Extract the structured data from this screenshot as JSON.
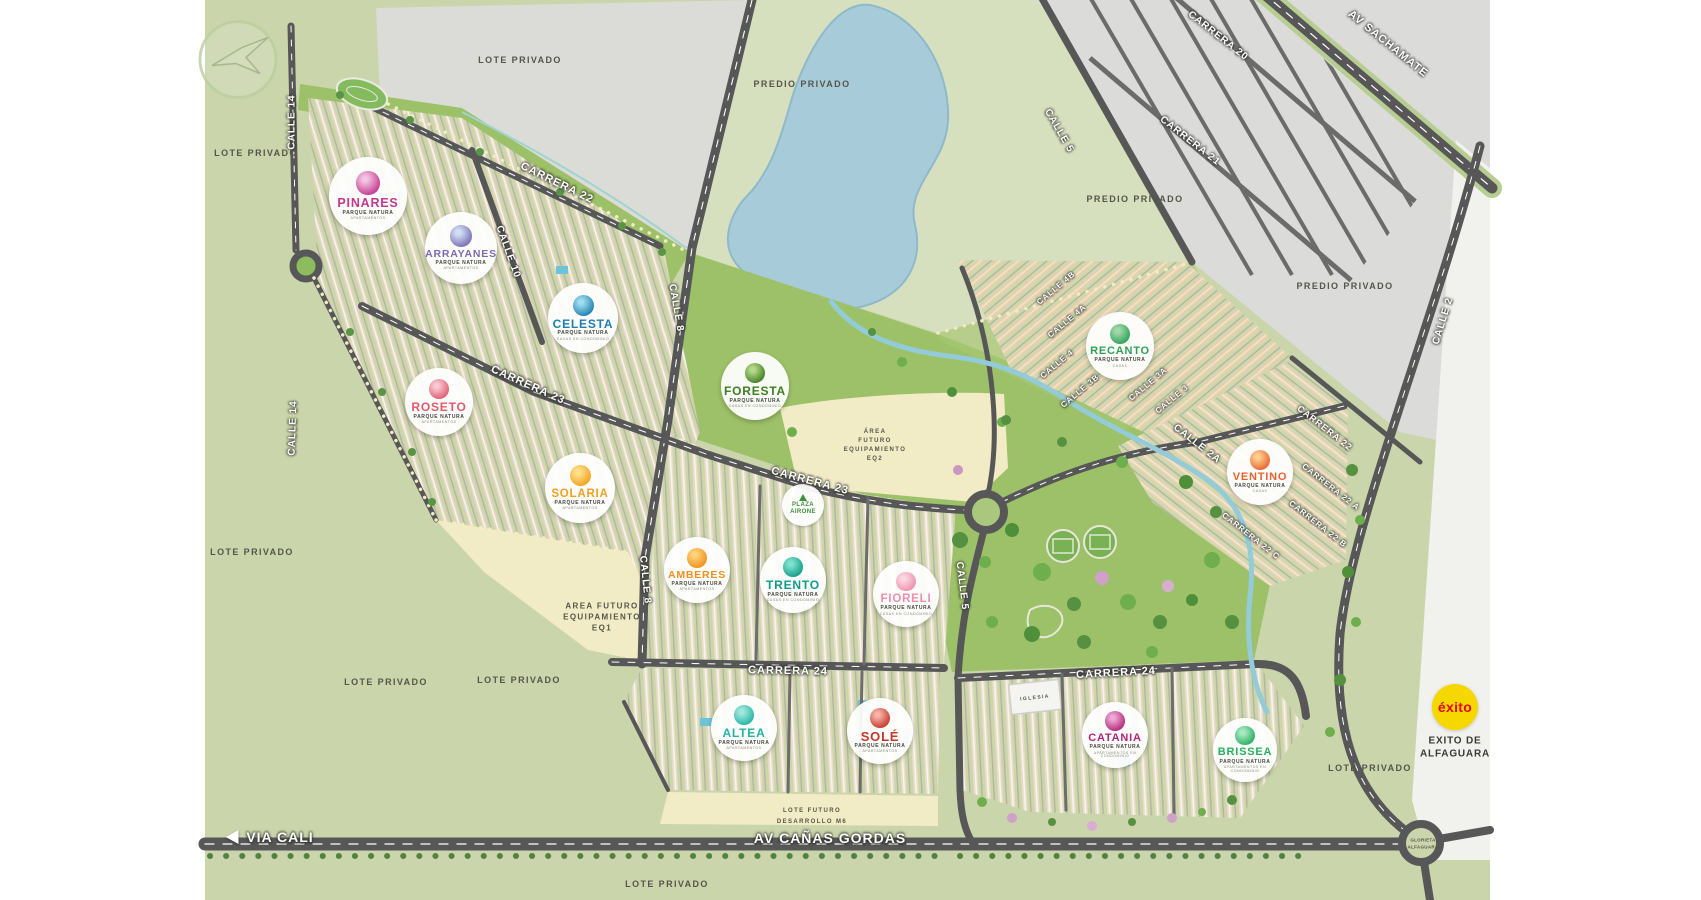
{
  "map_title": "Parque Natura masterplan",
  "brand": {
    "master_brand": "PARQUE NATURA",
    "developer_logo": "swallow-bird-logo"
  },
  "projects": [
    {
      "name": "PINARES",
      "brand": "PARQUE NATURA",
      "type": "APARTAMENTOS",
      "color": "#c1388e"
    },
    {
      "name": "ARRAYANES",
      "brand": "PARQUE NATURA",
      "type": "APARTAMENTOS",
      "color": "#7a6ab2"
    },
    {
      "name": "CELESTA",
      "brand": "PARQUE NATURA",
      "type": "CASAS EN CONDOMINIO",
      "color": "#1d7fae"
    },
    {
      "name": "FORESTA",
      "brand": "PARQUE NATURA",
      "type": "CASAS EN CONDOMINIO",
      "color": "#3e7d23"
    },
    {
      "name": "ROSETO",
      "brand": "PARQUE NATURA",
      "type": "APARTAMENTOS",
      "color": "#e05a6e"
    },
    {
      "name": "SOLARIA",
      "brand": "PARQUE NATURA",
      "type": "APARTAMENTOS",
      "color": "#f0a11f"
    },
    {
      "name": "AMBERES",
      "brand": "PARQUE NATURA",
      "type": "APARTAMENTOS",
      "color": "#ef8f1c"
    },
    {
      "name": "TRENTO",
      "brand": "PARQUE NATURA",
      "type": "CASAS EN CONDOMINIO",
      "color": "#0f9c86"
    },
    {
      "name": "FIORELI",
      "brand": "PARQUE NATURA",
      "type": "CASAS EN CONDOMINIO",
      "color": "#ec8fae"
    },
    {
      "name": "RECANTO",
      "brand": "PARQUE NATURA",
      "type": "CASAS",
      "color": "#2ea156"
    },
    {
      "name": "VENTINO",
      "brand": "PARQUE NATURA",
      "type": "CASAS",
      "color": "#e86230"
    },
    {
      "name": "ALTEA",
      "brand": "PARQUE NATURA",
      "type": "APARTAMENTOS",
      "color": "#23b3a2"
    },
    {
      "name": "SOLÉ",
      "brand": "PARQUE NATURA",
      "type": "APARTAMENTOS",
      "color": "#c0392b"
    },
    {
      "name": "CATANIA",
      "brand": "PARQUE NATURA",
      "type": "APARTAMENTOS EN CONDOMINIO",
      "color": "#b02579"
    },
    {
      "name": "BRISSEA",
      "brand": "PARQUE NATURA",
      "type": "APARTAMENTOS EN CONDOMINIO",
      "color": "#27ae60"
    }
  ],
  "plaza": {
    "line1": "PLAZA",
    "line2": "AIRONE",
    "color": "#3f8f3f"
  },
  "exito": {
    "logo_text": "éxito",
    "label_line1": "EXITO DE",
    "label_line2": "ALFAGUARA",
    "logo_bg": "#f6d800",
    "logo_color": "#e30613"
  },
  "roads": {
    "via_cali": "VIA CALI",
    "av_canas_gordas": "AV CAÑAS GORDAS",
    "av_sachamate": "AV SACHAMATE",
    "carrera_20": "CARRERA 20",
    "carrera_21": "CARRERA 21",
    "carrera_22": "CARRERA 22",
    "carrera_22a": "CARRERA 22 A",
    "carrera_22b": "CARRERA 22 B",
    "carrera_22c": "CARRERA 22 C",
    "carrera_23": "CARRERA 23",
    "carrera_24": "CARRERA 24",
    "calle_2": "CALLE 2",
    "calle_2a": "CALLE 2A",
    "calle_3": "CALLE 3",
    "calle_3a": "CALLE 3A",
    "calle_3b": "CALLE 3B",
    "calle_4": "CALLE 4",
    "calle_4a": "CALLE 4A",
    "calle_4b": "CALLE 4B",
    "calle_5": "CALLE 5",
    "calle_8": "CALLE 8",
    "calle_10": "CALLE 10",
    "calle_14": "CALLE 14",
    "glorieta_line1": "GLORIETA",
    "glorieta_line2": "ALFAGUARA"
  },
  "areas": {
    "lote_privado": "LOTE PRIVADO",
    "predio_privado": "PREDIO PRIVADO",
    "eq1_lines": [
      "AREA FUTURO",
      "EQUIPAMIENTO",
      "EQ1"
    ],
    "eq2_lines": [
      "ÁREA",
      "FUTURO",
      "EQUIPAMIENTO",
      "EQ2"
    ],
    "lote_futuro_lines": [
      "LOTE FUTURO",
      "DESARROLLO M6"
    ],
    "iglesia": "IGLESIA"
  }
}
